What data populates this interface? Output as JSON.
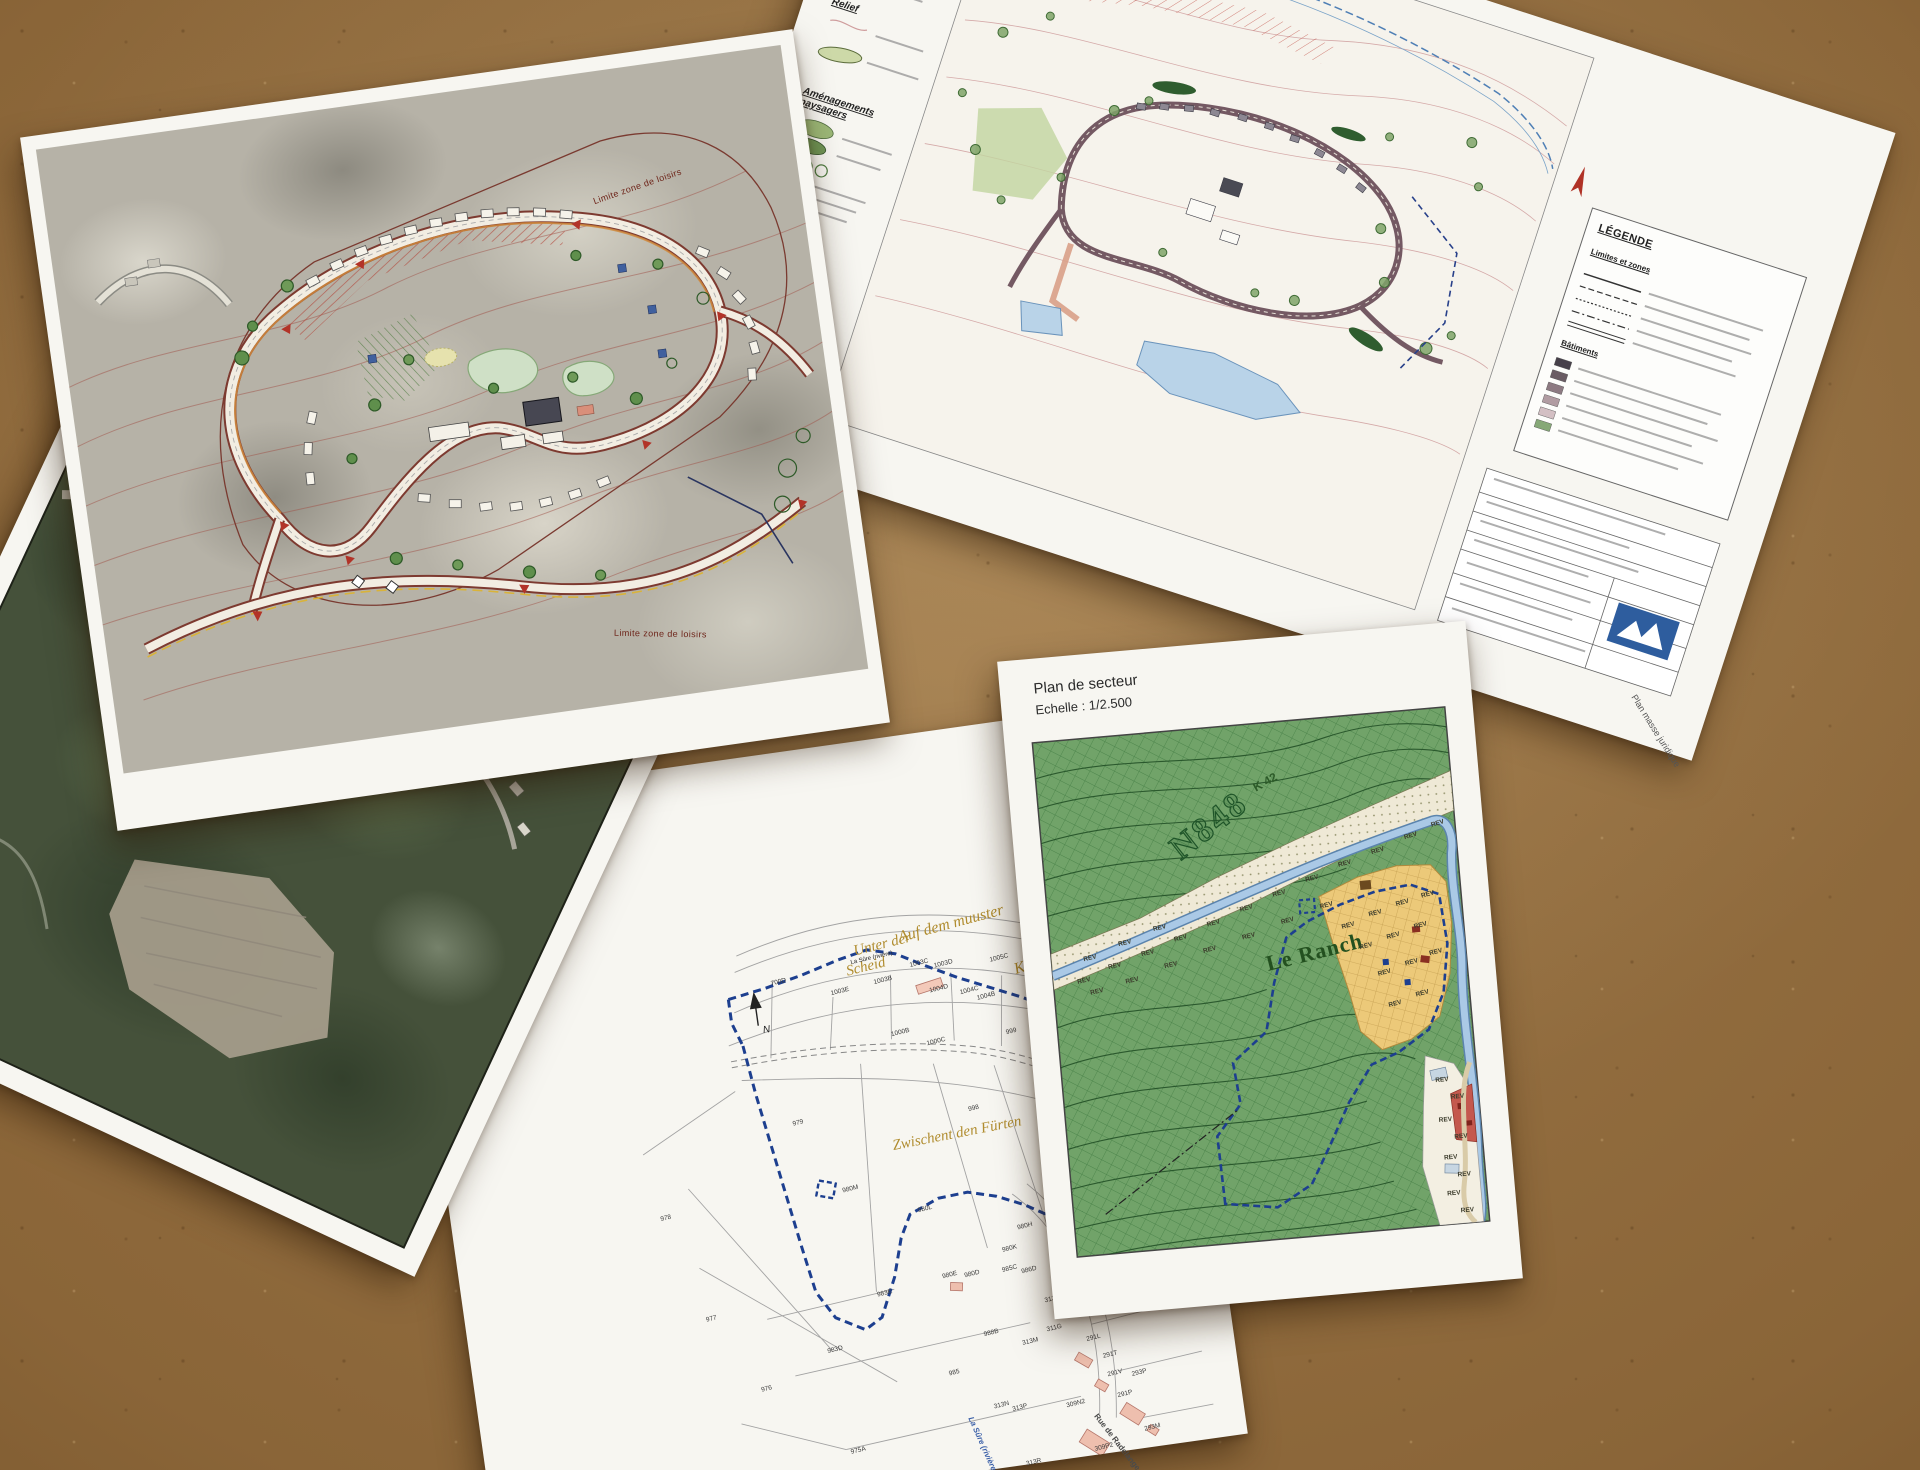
{
  "paper_aerial": {
    "corner_number": "18"
  },
  "paper_masterplan": {
    "boundary_label_top": "Limite zone de loisirs",
    "boundary_label_bottom": "Limite zone de loisirs"
  },
  "paper_plan_masse": {
    "legend_constructions": "Constructions",
    "legend_relief": "Relief",
    "legend_amenagements": "Aménagements paysagers",
    "legend_box_title": "LÉGENDE",
    "legend_limites": "Limites et zones",
    "legend_batiments": "Bâtiments",
    "caption": "Plan masse juridique",
    "swatch_colors": [
      "#46404a",
      "#645660",
      "#83707a",
      "#a38e96",
      "#c3abb1",
      "#e2ccd0"
    ],
    "batiments_colors": [
      "#46404a",
      "#6a5c64",
      "#8d7a82",
      "#b19ca2",
      "#d3bfc3",
      "#86a877"
    ]
  },
  "paper_secteur": {
    "title": "Plan de secteur",
    "scale": "Echelle : 1/2.500",
    "road_code": "N848",
    "place_name": "Le Ranch",
    "road_ref": "K 42",
    "zone_label": "REV",
    "rev_positions": [
      [
        52,
        322,
        -8
      ],
      [
        84,
        310,
        -8
      ],
      [
        118,
        300,
        -8
      ],
      [
        152,
        288,
        -10
      ],
      [
        186,
        276,
        -10
      ],
      [
        220,
        264,
        -10
      ],
      [
        254,
        252,
        -10
      ],
      [
        288,
        240,
        -10
      ],
      [
        322,
        228,
        -10
      ],
      [
        356,
        218,
        -12
      ],
      [
        390,
        206,
        -12
      ],
      [
        418,
        196,
        -12
      ],
      [
        64,
        334,
        -8
      ],
      [
        100,
        326,
        -8
      ],
      [
        140,
        314,
        -8
      ],
      [
        180,
        302,
        -10
      ],
      [
        220,
        292,
        -10
      ],
      [
        260,
        280,
        -10
      ],
      [
        300,
        268,
        -10
      ],
      [
        60,
        300,
        -8
      ],
      [
        96,
        288,
        -8
      ],
      [
        132,
        276,
        -8
      ],
      [
        320,
        290,
        -10
      ],
      [
        348,
        280,
        -10
      ],
      [
        376,
        272,
        -10
      ],
      [
        402,
        266,
        -10
      ],
      [
        336,
        312,
        -10
      ],
      [
        364,
        304,
        -10
      ],
      [
        392,
        296,
        -10
      ],
      [
        352,
        340,
        -10
      ],
      [
        380,
        332,
        -10
      ],
      [
        405,
        324,
        -10
      ],
      [
        360,
        372,
        -10
      ],
      [
        388,
        364,
        -10
      ],
      [
        400,
        452,
        0
      ],
      [
        414,
        470,
        0
      ],
      [
        400,
        492,
        0
      ],
      [
        414,
        510,
        0
      ],
      [
        402,
        530,
        0
      ],
      [
        414,
        548,
        0
      ],
      [
        402,
        566,
        0
      ],
      [
        414,
        584,
        0
      ]
    ]
  },
  "paper_cadastre": {
    "north_label": "N",
    "river_label": "La Sûre (rivière)",
    "place_names": [
      {
        "t": "Unter der",
        "x": 436,
        "y": 200,
        "s": 15,
        "r": -6
      },
      {
        "t": "Scheid",
        "x": 426,
        "y": 219,
        "s": 15,
        "r": -6
      },
      {
        "t": "Auf dem muuster",
        "x": 482,
        "y": 192,
        "s": 16,
        "r": -7
      },
      {
        "t": "Kaul",
        "x": 592,
        "y": 240,
        "s": 16,
        "r": -10
      },
      {
        "t": "Zwischent den Fürten",
        "x": 448,
        "y": 398,
        "s": 15,
        "r": -3
      }
    ],
    "road_labels": [
      {
        "t": "Route de Radelange",
        "x": 664,
        "y": 316,
        "r": 48,
        "s": 7,
        "c": "dark"
      },
      {
        "t": "Rue de Radelange",
        "x": 616,
        "y": 698,
        "r": 60,
        "s": 8,
        "c": ""
      },
      {
        "t": "La Sûre (rivière)",
        "x": 492,
        "y": 684,
        "r": 74,
        "s": 8,
        "c": "blue"
      },
      {
        "t": "La Sûre (rivière)",
        "x": 432,
        "y": 216,
        "r": -5,
        "s": 6,
        "c": "dark"
      }
    ],
    "parcel_labels": [
      {
        "t": "700D",
        "x": 350,
        "y": 225
      },
      {
        "t": "1003E",
        "x": 408,
        "y": 243
      },
      {
        "t": "1003B",
        "x": 452,
        "y": 238
      },
      {
        "t": "1003C",
        "x": 490,
        "y": 226
      },
      {
        "t": "1003D",
        "x": 514,
        "y": 230
      },
      {
        "t": "1004D",
        "x": 506,
        "y": 254
      },
      {
        "t": "1004C",
        "x": 536,
        "y": 260
      },
      {
        "t": "1004B",
        "x": 552,
        "y": 268
      },
      {
        "t": "1005C",
        "x": 570,
        "y": 232
      },
      {
        "t": "990C",
        "x": 616,
        "y": 288
      },
      {
        "t": "990B",
        "x": 634,
        "y": 312
      },
      {
        "t": "1006B",
        "x": 658,
        "y": 294
      },
      {
        "t": "995V",
        "x": 654,
        "y": 342
      },
      {
        "t": "999",
        "x": 576,
        "y": 306
      },
      {
        "t": "1000B",
        "x": 462,
        "y": 292
      },
      {
        "t": "1000C",
        "x": 496,
        "y": 306
      },
      {
        "t": "997N",
        "x": 608,
        "y": 374
      },
      {
        "t": "998",
        "x": 528,
        "y": 377
      },
      {
        "t": "979",
        "x": 352,
        "y": 367
      },
      {
        "t": "980M",
        "x": 392,
        "y": 440
      },
      {
        "t": "980L",
        "x": 464,
        "y": 470
      },
      {
        "t": "978",
        "x": 208,
        "y": 443
      },
      {
        "t": "977",
        "x": 239,
        "y": 549
      },
      {
        "t": "983E",
        "x": 412,
        "y": 548
      },
      {
        "t": "983D",
        "x": 355,
        "y": 597
      },
      {
        "t": "976",
        "x": 284,
        "y": 626
      },
      {
        "t": "975A",
        "x": 364,
        "y": 700
      },
      {
        "t": "985",
        "x": 472,
        "y": 636
      },
      {
        "t": "988B",
        "x": 512,
        "y": 602
      },
      {
        "t": "980E",
        "x": 479,
        "y": 539
      },
      {
        "t": "980D",
        "x": 501,
        "y": 541
      },
      {
        "t": "980K",
        "x": 542,
        "y": 521
      },
      {
        "t": "980H",
        "x": 560,
        "y": 501
      },
      {
        "t": "985C",
        "x": 539,
        "y": 541
      },
      {
        "t": "986D",
        "x": 558,
        "y": 545
      },
      {
        "t": "313K",
        "x": 577,
        "y": 577
      },
      {
        "t": "311G",
        "x": 575,
        "y": 606
      },
      {
        "t": "313M",
        "x": 549,
        "y": 616
      },
      {
        "t": "313N",
        "x": 512,
        "y": 675
      },
      {
        "t": "313P",
        "x": 530,
        "y": 680
      },
      {
        "t": "313R",
        "x": 536,
        "y": 736
      },
      {
        "t": "309N2",
        "x": 584,
        "y": 684
      },
      {
        "t": "309P2",
        "x": 606,
        "y": 731
      },
      {
        "t": "291L",
        "x": 613,
        "y": 621
      },
      {
        "t": "291T",
        "x": 627,
        "y": 640
      },
      {
        "t": "291V",
        "x": 629,
        "y": 659
      },
      {
        "t": "291P",
        "x": 636,
        "y": 681
      },
      {
        "t": "293P",
        "x": 653,
        "y": 662
      },
      {
        "t": "293M",
        "x": 658,
        "y": 718
      }
    ]
  }
}
